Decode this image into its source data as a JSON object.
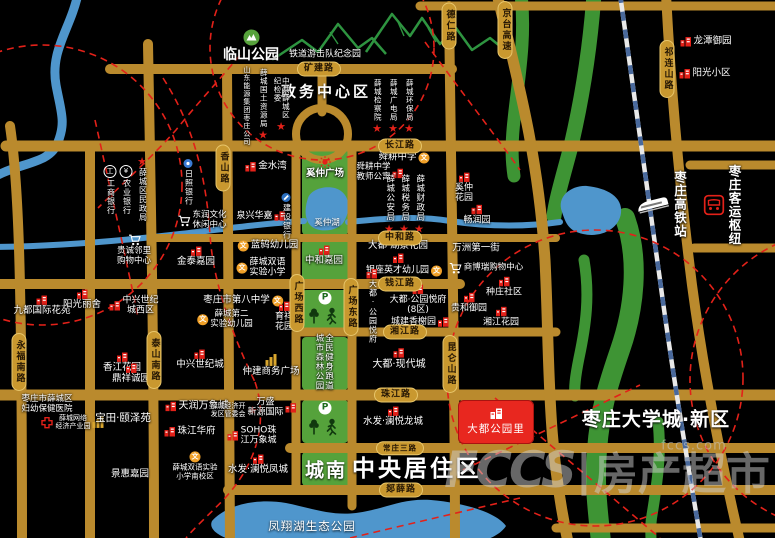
{
  "meta": {
    "width": 775,
    "height": 538,
    "watermark_small": "fccs.com",
    "watermark_big_latin": "FCCS",
    "watermark_big_sep": "|",
    "watermark_big_cjk": "房产超市"
  },
  "palette": {
    "background": "#000000",
    "road": "#BA8A2D",
    "road_label_bg": "#C9982F",
    "green": "#55A23B",
    "water": "#4F96CC",
    "red_accent": "#E32119",
    "landmark_red": "#E8271F",
    "railway_blue": "#49699C"
  },
  "landmark": {
    "text": "大都公园里",
    "x": 458,
    "y": 400,
    "w": 76,
    "h": 44
  },
  "road_labels": [
    {
      "name": "kuangjian",
      "text": "矿建路",
      "x": 319,
      "y": 69,
      "dir": "h"
    },
    {
      "name": "changjiang",
      "text": "长江路",
      "x": 400,
      "y": 146,
      "dir": "h"
    },
    {
      "name": "zhonghe",
      "text": "中和路",
      "x": 400,
      "y": 238,
      "dir": "h"
    },
    {
      "name": "qianjiang",
      "text": "钱江路",
      "x": 400,
      "y": 284,
      "dir": "h"
    },
    {
      "name": "xiangjiang",
      "text": "湘江路",
      "x": 405,
      "y": 332,
      "dir": "h"
    },
    {
      "name": "zhujiang",
      "text": "珠江路",
      "x": 396,
      "y": 395,
      "dir": "h"
    },
    {
      "name": "changzhuang",
      "text": "常庄三路",
      "x": 400,
      "y": 448,
      "dir": "h",
      "fs": 7.5
    },
    {
      "name": "tanxue",
      "text": "郯薛路",
      "x": 401,
      "y": 490,
      "dir": "h"
    },
    {
      "name": "deren",
      "text": "德仁路",
      "x": 449,
      "y": 26,
      "dir": "v"
    },
    {
      "name": "jingtai",
      "text": "京台高速",
      "x": 505,
      "y": 30,
      "dir": "v"
    },
    {
      "name": "qilianshan",
      "text": "祁连山路",
      "x": 667,
      "y": 69,
      "dir": "v"
    },
    {
      "name": "xiangshan",
      "text": "香山路",
      "x": 223,
      "y": 168,
      "dir": "v"
    },
    {
      "name": "yongfunan",
      "text": "永福南路",
      "x": 19,
      "y": 362,
      "dir": "v"
    },
    {
      "name": "taishannan",
      "text": "泰山南路",
      "x": 154,
      "y": 360,
      "dir": "v"
    },
    {
      "name": "gcxi",
      "text": "广场西路",
      "x": 297,
      "y": 303,
      "dir": "v"
    },
    {
      "name": "gcdong",
      "text": "广场东路",
      "x": 351,
      "y": 307,
      "dir": "v"
    },
    {
      "name": "kunlunshan",
      "text": "昆仑山路",
      "x": 450,
      "y": 364,
      "dir": "v"
    }
  ],
  "area_labels": [
    {
      "name": "zhengwu-center",
      "text": "政务中心区",
      "x": 326,
      "y": 91,
      "fs": 15,
      "bold": true,
      "ls": 3
    },
    {
      "name": "tiedao-park",
      "text": "铁道游击队纪念园",
      "x": 325,
      "y": 53,
      "fs": 9,
      "bold": false,
      "ls": 0
    },
    {
      "name": "chengnan",
      "text": "城南",
      "x": 326,
      "y": 469,
      "fs": 19,
      "bold": true,
      "ls": 2
    },
    {
      "name": "zhongyang-juzhu",
      "text": "中央居住",
      "x": 404,
      "y": 466,
      "fs": 23,
      "bold": true,
      "ls": 3
    },
    {
      "name": "qu",
      "text": "区",
      "x": 467,
      "y": 466,
      "fs": 23,
      "bold": true,
      "ls": 0
    },
    {
      "name": "daxuecheng",
      "text": "枣庄大学城·新区",
      "x": 656,
      "y": 418,
      "fs": 19,
      "bold": true,
      "ls": 1
    },
    {
      "name": "fengxianghu",
      "text": "凤翔湖生态公园",
      "x": 312,
      "y": 526,
      "fs": 11.5,
      "bold": false,
      "ls": 1
    },
    {
      "name": "xizhonghu",
      "text": "奚仲湖",
      "x": 327,
      "y": 222,
      "fs": 8.5,
      "bold": false,
      "ls": 0
    }
  ],
  "green_blocks": [
    {
      "name": "block-xizhong-plaza",
      "x": 302,
      "y": 147,
      "w": 46,
      "h": 88
    },
    {
      "name": "block-zhonghe-jiayuan",
      "x": 302,
      "y": 240,
      "w": 46,
      "h": 43
    },
    {
      "name": "block-forest-north",
      "x": 302,
      "y": 290,
      "w": 46,
      "h": 38
    },
    {
      "name": "block-forest-mid",
      "x": 302,
      "y": 337,
      "w": 46,
      "h": 53
    },
    {
      "name": "block-forest-south",
      "x": 302,
      "y": 400,
      "w": 46,
      "h": 43
    },
    {
      "name": "block-chengnan",
      "x": 302,
      "y": 452,
      "w": 48,
      "h": 34
    }
  ],
  "pois": [
    {
      "name": "linshan-park",
      "icon": "parkbadge",
      "side": "t",
      "fs": 14,
      "bold": true,
      "x": 251,
      "y": 46,
      "lines": [
        "临山公园"
      ]
    },
    {
      "name": "icbc-bank",
      "icon": "bank",
      "ic": "工",
      "side": "t",
      "dir": "v",
      "fs": 8,
      "x": 110,
      "y": 190,
      "lines": [
        "工商银行"
      ]
    },
    {
      "name": "abc-bank",
      "icon": "bank",
      "ic": "¥",
      "side": "t",
      "dir": "v",
      "fs": 8,
      "x": 126,
      "y": 190,
      "lines": [
        "农业银行"
      ]
    },
    {
      "name": "minzhengju",
      "icon": "star",
      "side": "t",
      "dir": "v",
      "fs": 8,
      "x": 142,
      "y": 189,
      "lines": [
        "薛城区民政局"
      ]
    },
    {
      "name": "rizhao-bank",
      "icon": "dotblue",
      "side": "t",
      "dir": "v",
      "fs": 8,
      "x": 188,
      "y": 182,
      "lines": [
        "日照银行"
      ]
    },
    {
      "name": "dongrun-center",
      "icon": "cart",
      "side": "l",
      "fs": 8.5,
      "x": 202,
      "y": 221,
      "lines": [
        "东润文化",
        "休闲中心"
      ]
    },
    {
      "name": "guicheng-mall",
      "icon": "cart",
      "side": "t",
      "fs": 8.5,
      "x": 134,
      "y": 250,
      "lines": [
        "贵诚邻里",
        "购物中心"
      ]
    },
    {
      "name": "jintai-jiayuan",
      "icon": "bred",
      "side": "t",
      "fs": 9.5,
      "x": 196,
      "y": 257,
      "lines": [
        "金泰嘉园"
      ]
    },
    {
      "name": "jinshuiwan",
      "icon": "bred",
      "side": "l",
      "fs": 9.5,
      "x": 266,
      "y": 167,
      "lines": [
        "金水湾"
      ]
    },
    {
      "name": "quanxing-huajia",
      "icon": "bred",
      "side": "r",
      "fs": 9,
      "x": 261,
      "y": 216,
      "lines": [
        "泉兴华嘉"
      ]
    },
    {
      "name": "ccb-bank",
      "icon": "ccb",
      "side": "t",
      "dir": "v",
      "fs": 8,
      "x": 286,
      "y": 216,
      "lines": [
        "建设银行"
      ]
    },
    {
      "name": "shandong-nengyuan",
      "fs": 7,
      "dir": "v",
      "x": 246,
      "y": 106,
      "lines": [
        "山东能源集团枣庄公司"
      ]
    },
    {
      "name": "guotu-ziyuanju",
      "icon": "star",
      "side": "b",
      "dir": "v",
      "fs": 7.5,
      "x": 263,
      "y": 104,
      "lines": [
        "薛城国土资源局"
      ]
    },
    {
      "name": "jijianwei",
      "icon": "star",
      "side": "b",
      "dir": "v",
      "fs": 7.5,
      "x": 281,
      "y": 104,
      "lines": [
        "中共薛城区",
        "纪检委"
      ]
    },
    {
      "name": "jianchayuan",
      "icon": "star",
      "side": "b",
      "dir": "v",
      "fs": 7.5,
      "x": 377,
      "y": 106,
      "lines": [
        "薛城检察院"
      ]
    },
    {
      "name": "guangdianju",
      "icon": "star",
      "side": "b",
      "dir": "v",
      "fs": 7.5,
      "x": 393,
      "y": 106,
      "lines": [
        "薛城广电局"
      ]
    },
    {
      "name": "huanbaoju",
      "icon": "star",
      "side": "b",
      "dir": "v",
      "fs": 7.5,
      "x": 409,
      "y": 106,
      "lines": [
        "薛城环保局"
      ]
    },
    {
      "name": "longtan-yuyuan",
      "icon": "bred",
      "side": "l",
      "fs": 9.5,
      "x": 706,
      "y": 42,
      "lines": [
        "龙潭御园"
      ]
    },
    {
      "name": "yangguang-xiaoqu",
      "icon": "bred",
      "side": "l",
      "fs": 9.5,
      "x": 705,
      "y": 74,
      "lines": [
        "阳光小区"
      ]
    },
    {
      "name": "xizhong-plaza",
      "icon": "sun",
      "side": "t",
      "fs": 9.5,
      "bold": true,
      "x": 325,
      "y": 168,
      "lines": [
        "奚仲广场"
      ]
    },
    {
      "name": "zhonghe-jiayuan",
      "icon": "bred",
      "side": "t",
      "fs": 9.5,
      "x": 324,
      "y": 256,
      "lines": [
        "中和嘉园"
      ]
    },
    {
      "name": "shungeng-school",
      "icon": "school",
      "side": "r",
      "fs": 9.5,
      "x": 404,
      "y": 158,
      "lines": [
        "舜耕中学"
      ]
    },
    {
      "name": "shungeng-apartment",
      "icon": "bred",
      "side": "r",
      "fs": 8.5,
      "x": 380,
      "y": 173,
      "lines": [
        "舜耕中学",
        "教师公寓"
      ]
    },
    {
      "name": "gonganju",
      "icon": "star",
      "side": "b",
      "dir": "v",
      "fs": 8.5,
      "x": 389,
      "y": 204,
      "lines": [
        "薛城公安局"
      ]
    },
    {
      "name": "shuiwuju",
      "icon": "star",
      "side": "b",
      "dir": "v",
      "fs": 8.5,
      "x": 404,
      "y": 204,
      "lines": [
        "薛城税务局"
      ]
    },
    {
      "name": "caizhengju",
      "icon": "star",
      "side": "b",
      "dir": "v",
      "fs": 8.5,
      "x": 419,
      "y": 204,
      "lines": [
        "薛城财政局"
      ]
    },
    {
      "name": "xizhong-huayuan",
      "icon": "bred",
      "side": "t",
      "fs": 9,
      "x": 464,
      "y": 188,
      "lines": [
        "奚仲",
        "花园"
      ]
    },
    {
      "name": "changrunyuan",
      "icon": "bred",
      "side": "t",
      "fs": 9,
      "x": 477,
      "y": 215,
      "lines": [
        "畅润园"
      ]
    },
    {
      "name": "dadu-hujing",
      "icon": "bred",
      "side": "b",
      "fs": 9.5,
      "x": 398,
      "y": 252,
      "lines": [
        "大都·湖景花园"
      ]
    },
    {
      "name": "yinzuo-kindergarten",
      "icon": "school",
      "side": "r",
      "fs": 9,
      "x": 404,
      "y": 271,
      "lines": [
        "银座英才幼儿园"
      ]
    },
    {
      "name": "wanzhou-street",
      "fs": 9.5,
      "x": 476,
      "y": 249,
      "lines": [
        "万洲第一街"
      ]
    },
    {
      "name": "shangborui-mall",
      "icon": "cart",
      "side": "l",
      "fs": 8.5,
      "x": 486,
      "y": 268,
      "lines": [
        "商博瑞购物中心"
      ]
    },
    {
      "name": "dadu-yuefu-v",
      "icon": "bred",
      "side": "t",
      "dir": "v",
      "fs": 8,
      "x": 372,
      "y": 306,
      "lines": [
        "大都·公园悦府"
      ]
    },
    {
      "name": "dadu-yuefu-8",
      "icon": "bred",
      "side": "t",
      "fs": 9,
      "x": 418,
      "y": 300,
      "lines": [
        "大都·公园悦府",
        "(8区)"
      ]
    },
    {
      "name": "chengjian-xiangxieyuan",
      "icon": "bred",
      "side": "r",
      "fs": 9,
      "x": 420,
      "y": 322,
      "lines": [
        "城建香榭园"
      ]
    },
    {
      "name": "zhongzhuang-shequ",
      "icon": "bred",
      "side": "t",
      "fs": 9,
      "x": 504,
      "y": 287,
      "lines": [
        "种庄社区"
      ]
    },
    {
      "name": "guihe-yuyuan",
      "icon": "bred",
      "side": "t",
      "fs": 9,
      "x": 469,
      "y": 303,
      "lines": [
        "贵和御园"
      ]
    },
    {
      "name": "xiangjiang-huayuan",
      "icon": "bred",
      "side": "t",
      "fs": 9,
      "x": 501,
      "y": 317,
      "lines": [
        "湘江花园"
      ]
    },
    {
      "name": "dadu-xiandaicheng",
      "icon": "bred",
      "side": "t",
      "fs": 10,
      "x": 399,
      "y": 359,
      "lines": [
        "大都·现代城"
      ]
    },
    {
      "name": "jiudu-huayuan",
      "icon": "bred",
      "side": "t",
      "fs": 9.5,
      "x": 42,
      "y": 306,
      "lines": [
        "九都国际花苑"
      ]
    },
    {
      "name": "yangguang-lishe",
      "icon": "bred",
      "side": "t",
      "fs": 9.5,
      "x": 82,
      "y": 300,
      "lines": [
        "阳光丽舍"
      ]
    },
    {
      "name": "zhongxing-xiqu",
      "icon": "bred",
      "side": "l",
      "fs": 9,
      "x": 134,
      "y": 306,
      "lines": [
        "中兴世纪",
        "城西区"
      ]
    },
    {
      "name": "no8-school",
      "icon": "school",
      "side": "r",
      "fs": 9.5,
      "x": 243,
      "y": 301,
      "lines": [
        "枣庄市第八中学"
      ]
    },
    {
      "name": "xc2-kindergarten",
      "icon": "school",
      "side": "l",
      "fs": 8.5,
      "x": 225,
      "y": 320,
      "lines": [
        "薛城第二",
        "实验幼儿园"
      ]
    },
    {
      "name": "yuxiang-huayuan",
      "icon": "bred",
      "side": "t",
      "fs": 9,
      "x": 284,
      "y": 317,
      "lines": [
        "育祥",
        "花园"
      ]
    },
    {
      "name": "xiangjiang-hy",
      "icon": "bred",
      "side": "t",
      "fs": 9.5,
      "x": 122,
      "y": 363,
      "lines": [
        "香江花园"
      ]
    },
    {
      "name": "dingxiang-chengyuan",
      "icon": "bred",
      "side": "t",
      "fs": 9.5,
      "x": 131,
      "y": 374,
      "lines": [
        "鼎祥诚园"
      ]
    },
    {
      "name": "zhongxing-shijicheng",
      "icon": "bred",
      "side": "t",
      "fs": 9.5,
      "x": 200,
      "y": 360,
      "lines": [
        "中兴世纪城"
      ]
    },
    {
      "name": "zhongjian-plaza",
      "icon": "bgold",
      "side": "t",
      "fs": 9.5,
      "x": 271,
      "y": 366,
      "lines": [
        "仲建商务广场"
      ]
    },
    {
      "name": "fuyou-hospital",
      "icon": "hospital",
      "side": "b",
      "fs": 8.5,
      "x": 47,
      "y": 412,
      "lines": [
        "枣庄市薛城区",
        "妇幼保健医院"
      ]
    },
    {
      "name": "wangluo-park",
      "icon": "bgold",
      "side": "r",
      "fs": 7,
      "x": 80,
      "y": 422,
      "lines": [
        "薛城网络",
        "经济产业园"
      ]
    },
    {
      "name": "baotian-yizeyuan",
      "fs": 10.5,
      "x": 123,
      "y": 418,
      "lines": [
        "宝田·颐泽苑"
      ]
    },
    {
      "name": "jinghui-jiayuan",
      "fs": 9.5,
      "x": 130,
      "y": 475,
      "lines": [
        "景惠嘉园"
      ]
    },
    {
      "name": "tianrun-wanxiang",
      "icon": "bred",
      "side": "l",
      "fs": 10,
      "x": 197,
      "y": 406,
      "lines": [
        "天润万象城"
      ]
    },
    {
      "name": "jingkaiqu-guanweihui",
      "icon": "star",
      "side": "r",
      "fs": 7,
      "x": 234,
      "y": 410,
      "lines": [
        "薛城经济开",
        "发区管委会"
      ]
    },
    {
      "name": "wansheng-guoji",
      "icon": "bred",
      "side": "r",
      "fs": 9,
      "x": 272,
      "y": 408,
      "lines": [
        "万盛",
        "新源国际"
      ]
    },
    {
      "name": "zhujiang-huafu",
      "icon": "bred",
      "side": "l",
      "fs": 9.5,
      "x": 190,
      "y": 432,
      "lines": [
        "珠江华府"
      ]
    },
    {
      "name": "soho-wanxiang",
      "icon": "bred",
      "side": "l",
      "fs": 9,
      "x": 252,
      "y": 436,
      "lines": [
        "SOHO珠",
        "江万象城"
      ]
    },
    {
      "name": "shuangyu-south",
      "icon": "school",
      "side": "t",
      "fs": 7.5,
      "x": 195,
      "y": 466,
      "lines": [
        "薛城双语实验",
        "小学南校区"
      ]
    },
    {
      "name": "shuifa-fengcheng",
      "icon": "bred",
      "side": "t",
      "fs": 9.5,
      "x": 258,
      "y": 465,
      "lines": [
        "水发·澜悦凤城"
      ]
    },
    {
      "name": "shuifa-longcheng",
      "icon": "bred",
      "side": "t",
      "fs": 9.5,
      "x": 393,
      "y": 417,
      "lines": [
        "水发·澜悦龙城"
      ]
    },
    {
      "name": "landun-kindergarten",
      "icon": "school",
      "side": "l",
      "fs": 9.5,
      "x": 268,
      "y": 246,
      "lines": [
        "蓝鸫幼儿园"
      ]
    },
    {
      "name": "shuangyu-school",
      "icon": "school",
      "side": "l",
      "fs": 9,
      "x": 261,
      "y": 268,
      "lines": [
        "薛城双语",
        "实验小学"
      ]
    },
    {
      "name": "gaotie-station",
      "icon": "train",
      "side": "l",
      "dir": "v",
      "fs": 12.5,
      "bold": true,
      "x": 660,
      "y": 204,
      "lines": [
        "枣庄高铁站"
      ]
    },
    {
      "name": "keyun-hub",
      "icon": "bus",
      "side": "l",
      "dir": "v",
      "fs": 12.5,
      "bold": true,
      "x": 722,
      "y": 205,
      "lines": [
        "枣庄客运枢纽"
      ]
    },
    {
      "name": "forest-park-text",
      "dir": "v",
      "fs": 8.5,
      "x": 323,
      "y": 362,
      "lines": [
        "全民健身跑道",
        "城市森林公园"
      ]
    },
    {
      "name": "park-north-parking",
      "icon": "pbadge",
      "x": 325,
      "y": 298,
      "lines": []
    },
    {
      "name": "park-north-fitness",
      "icon": "treerun",
      "x": 325,
      "y": 316,
      "lines": []
    },
    {
      "name": "park-south-parking",
      "icon": "pbadge",
      "x": 325,
      "y": 408,
      "lines": []
    },
    {
      "name": "park-south-fitness",
      "icon": "treerun",
      "x": 325,
      "y": 427,
      "lines": []
    }
  ]
}
